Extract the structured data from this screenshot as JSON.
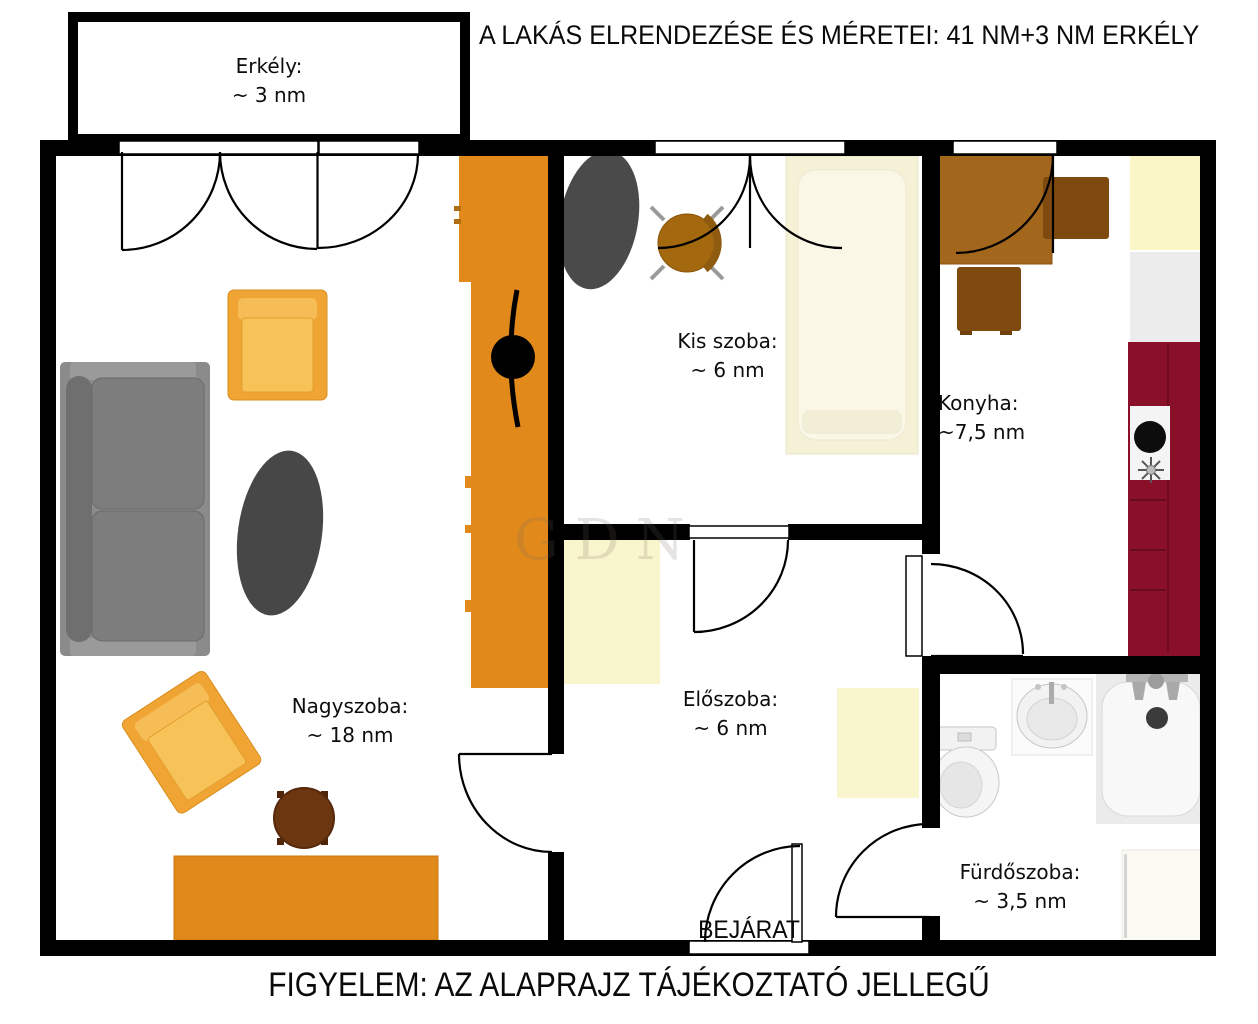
{
  "title": "A LAKÁS ELRENDEZÉSE ÉS MÉRETEI: 41 NM+3 NM ERKÉLY",
  "footer": "FIGYELEM: AZ ALAPRAJZ TÁJÉKOZTATÓ JELLEGŰ",
  "entrance": "BEJÁRAT",
  "watermark": "GDN",
  "rooms": {
    "balcony": {
      "name": "Erkély:",
      "area": "~ 3 nm"
    },
    "living": {
      "name": "Nagyszoba:",
      "area": "~ 18 nm"
    },
    "small_room": {
      "name": "Kis szoba:",
      "area": "~ 6 nm"
    },
    "kitchen": {
      "name": "Konyha:",
      "area": "~7,5 nm"
    },
    "hall": {
      "name": "Előszoba:",
      "area": "~ 6 nm"
    },
    "bathroom": {
      "name": "Fürdőszoba:",
      "area": "~ 3,5 nm"
    }
  },
  "colors": {
    "wall": "#000000",
    "cabinet_orange": "#E1891B",
    "armchair_gold": "#EFA434",
    "sofa_gray": "#8B8B8B",
    "rug_dark": "#474747",
    "counter_maroon": "#8A0F28",
    "furniture_cream": "#F9F5CC",
    "bed_cream": "#F5F1D6",
    "table_brown": "#A2661D",
    "chair_brown": "#7E4A10"
  }
}
